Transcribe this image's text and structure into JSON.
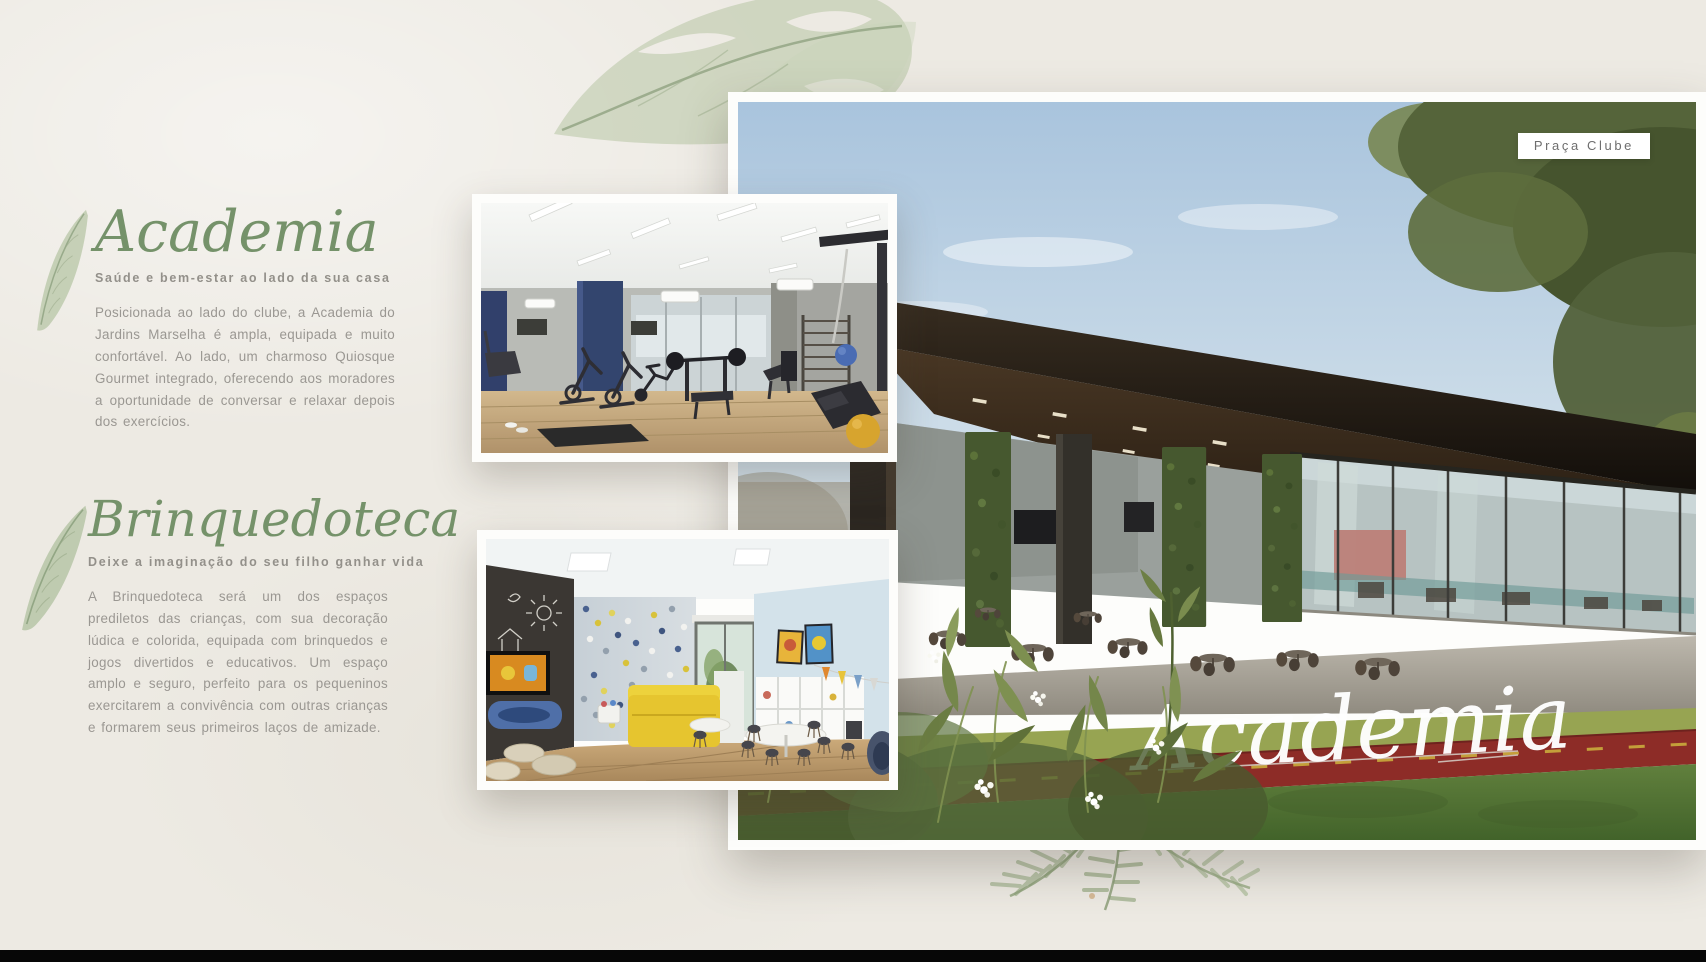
{
  "page": {
    "background_color": "#edeae3",
    "accent_green": "#75926a",
    "subtitle_gray": "#93908a",
    "body_gray": "#9a9792",
    "badge_text_gray": "#6e6e6e",
    "track_red": "#8d2c27",
    "bottom_bar_color": "#070707"
  },
  "sections": {
    "academia": {
      "title": "Academia",
      "subtitle": "Saúde e bem-estar ao lado da sua casa",
      "body": "Posicionada ao lado do clube, a Academia do Jardins Marselha é ampla, equipada e muito confortável. Ao lado, um charmoso Quiosque Gourmet integrado, oferecendo aos moradores a oportunidade de conversar e relaxar depois dos exercícios."
    },
    "brinquedoteca": {
      "title": "Brinquedoteca",
      "subtitle": "Deixe a imaginação do seu filho ganhar vida",
      "body": "A Brinquedoteca será um dos espaços prediletos das crianças, com sua decoração lúdica e colorida, equipada com brinquedos e jogos divertidos e educativos. Um espaço amplo e seguro, perfeito para os pequeninos exercitarem a convivência com outras crianças e formarem seus primeiros laços de amizade."
    }
  },
  "hero": {
    "badge_label": "Praça Clube",
    "caption": "Academia"
  }
}
